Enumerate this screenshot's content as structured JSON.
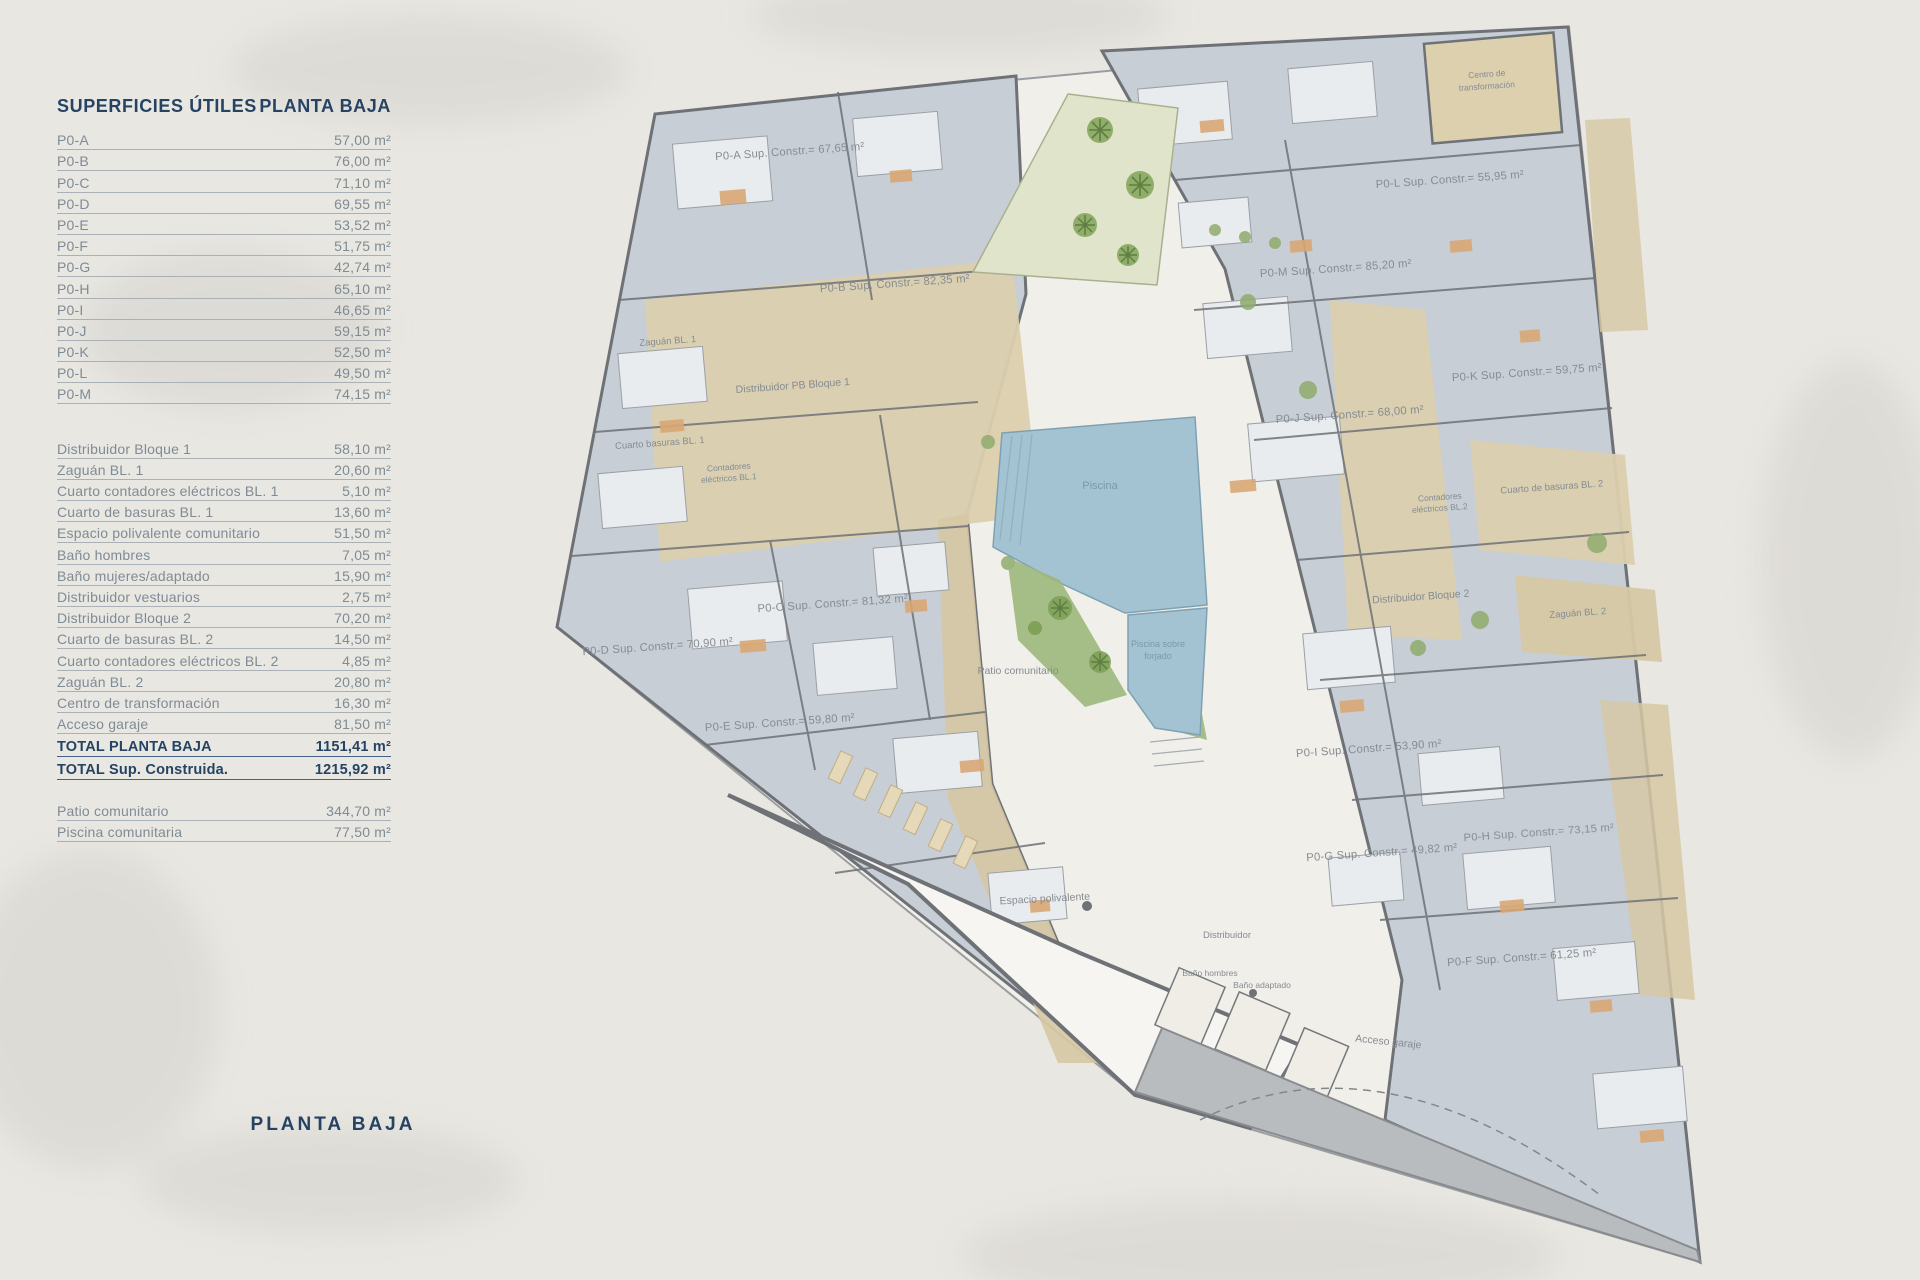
{
  "table": {
    "title_left": "SUPERFICIES ÚTILES",
    "title_right": "PLANTA BAJA",
    "units": [
      {
        "label": "P0-A",
        "value": "57,00 m²"
      },
      {
        "label": "P0-B",
        "value": "76,00 m²"
      },
      {
        "label": "P0-C",
        "value": "71,10 m²"
      },
      {
        "label": "P0-D",
        "value": "69,55 m²"
      },
      {
        "label": "P0-E",
        "value": "53,52 m²"
      },
      {
        "label": "P0-F",
        "value": "51,75 m²"
      },
      {
        "label": "P0-G",
        "value": "42,74 m²"
      },
      {
        "label": "P0-H",
        "value": "65,10 m²"
      },
      {
        "label": "P0-I",
        "value": "46,65 m²"
      },
      {
        "label": "P0-J",
        "value": "59,15 m²"
      },
      {
        "label": "P0-K",
        "value": "52,50 m²"
      },
      {
        "label": "P0-L",
        "value": "49,50 m²"
      },
      {
        "label": "P0-M",
        "value": "74,15 m²"
      }
    ],
    "commons": [
      {
        "label": "Distribuidor Bloque 1",
        "value": "58,10 m²"
      },
      {
        "label": "Zaguán BL. 1",
        "value": "20,60 m²"
      },
      {
        "label": "Cuarto contadores eléctricos BL. 1",
        "value": "5,10 m²"
      },
      {
        "label": "Cuarto de basuras BL. 1",
        "value": "13,60 m²"
      },
      {
        "label": "Espacio polivalente comunitario",
        "value": "51,50 m²"
      },
      {
        "label": "Baño hombres",
        "value": "7,05 m²"
      },
      {
        "label": "Baño mujeres/adaptado",
        "value": "15,90 m²"
      },
      {
        "label": "Distribuidor vestuarios",
        "value": "2,75 m²"
      },
      {
        "label": "Distribuidor Bloque 2",
        "value": "70,20 m²"
      },
      {
        "label": "Cuarto de basuras BL. 2",
        "value": "14,50 m²"
      },
      {
        "label": "Cuarto contadores eléctricos BL. 2",
        "value": "4,85 m²"
      },
      {
        "label": "Zaguán BL. 2",
        "value": "20,80 m²"
      },
      {
        "label": "Centro de transformación",
        "value": "16,30 m²"
      },
      {
        "label": "Acceso garaje",
        "value": "81,50 m²"
      }
    ],
    "totals": [
      {
        "label": "TOTAL PLANTA BAJA",
        "value": "1151,41 m²"
      },
      {
        "label": "TOTAL Sup. Construida.",
        "value": "1215,92 m²"
      }
    ],
    "outdoor": [
      {
        "label": "Patio comunitario",
        "value": "344,70 m²"
      },
      {
        "label": "Piscina comunitaria",
        "value": "77,50 m²"
      }
    ]
  },
  "footer": {
    "caption": "PLANTA BAJA"
  },
  "plan": {
    "labels": {
      "p0a": "P0-A Sup. Constr.= 67,65 m²",
      "p0b": "P0-B Sup. Constr.= 82,35 m²",
      "p0c": "P0-C Sup. Constr.= 81,32 m²",
      "p0d": "P0-D Sup. Constr.= 70,90 m²",
      "p0e": "P0-E Sup. Constr.= 59,80 m²",
      "p0f": "P0-F Sup. Constr.= 61,25 m²",
      "p0g": "P0-G Sup. Constr.= 49,82 m²",
      "p0h": "P0-H Sup. Constr.= 73,15 m²",
      "p0i": "P0-I Sup. Constr.= 53,90 m²",
      "p0j": "P0-J Sup. Constr.= 68,00 m²",
      "p0k": "P0-K Sup. Constr.= 59,75 m²",
      "p0l": "P0-L Sup. Constr.= 55,95 m²",
      "p0m": "P0-M Sup. Constr.= 85,20 m²",
      "zaguan1": "Zaguán BL. 1",
      "distribuidor1": "Distribuidor PB Bloque 1",
      "basuras1": "Cuarto basuras BL. 1",
      "contadores1_l1": "Contadores",
      "contadores1_l2": "eléctricos BL.1",
      "piscina": "Piscina",
      "piscina_forjado_l1": "Piscina sobre",
      "piscina_forjado_l2": "forjado",
      "patio": "Patio comunitario",
      "espacio": "Espacio polivalente",
      "distribuidor_pb": "Distribuidor",
      "bano_hombres": "Baño hombres",
      "bano_adaptado": "Baño adaptado",
      "acceso_garaje": "Acceso garaje",
      "centro_l1": "Centro de",
      "centro_l2": "transformación",
      "basuras2": "Cuarto de basuras BL. 2",
      "contadores2_l1": "Contadores",
      "contadores2_l2": "eléctricos BL.2",
      "distribuidor2": "Distribuidor Bloque 2",
      "zaguan2": "Zaguán BL. 2"
    }
  },
  "colors": {
    "page_bg": "#e9e7e2",
    "title_navy": "#264363",
    "row_text": "#7f8b95",
    "apartment_fill": "#c8ced6",
    "wall": "#6e7276",
    "terrace_beige": "#dbcfae",
    "courtyard": "#f1efe9",
    "pool_blue": "#a4c3d2",
    "garden_green": "#8fab6d",
    "ramp_gray": "#b9bcbf"
  }
}
